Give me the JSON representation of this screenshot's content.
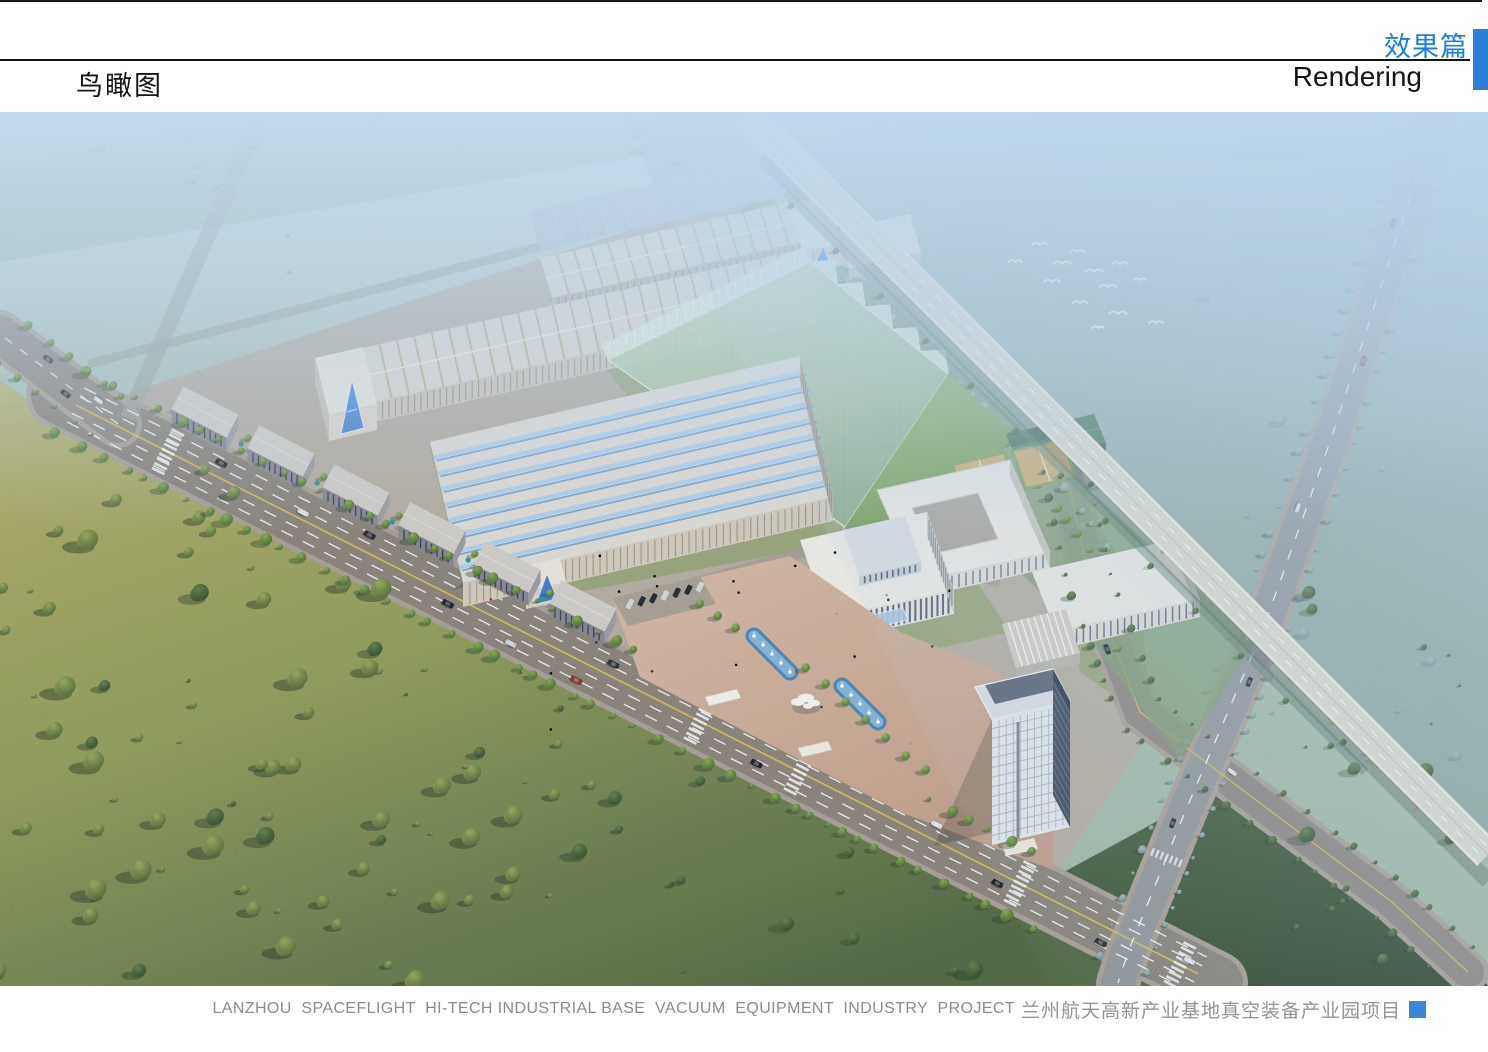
{
  "header": {
    "section_label_cn": "效果篇",
    "section_label_en": "Rendering",
    "page_title": "鸟瞰图"
  },
  "footer": {
    "caption_en": "LANZHOU  SPACEFLIGHT  HI-TECH INDUSTRIAL BASE  VACUUM  EQUIPMENT  INDUSTRY  PROJECT",
    "caption_cn": "兰州航天高新产业基地真空装备产业园项目"
  },
  "colors": {
    "accent_blue_tab": "#2e80d6",
    "title_blue": "#1a7ce6",
    "caption_square_blue": "#3a87d8",
    "caption_grey": "#8b8b8b"
  },
  "scene": {
    "type": "architectural-aerial-rendering",
    "subject": "industrial park bird's-eye view with factory halls, office campus, plaza fountains, elevated expressway and tree fields"
  }
}
